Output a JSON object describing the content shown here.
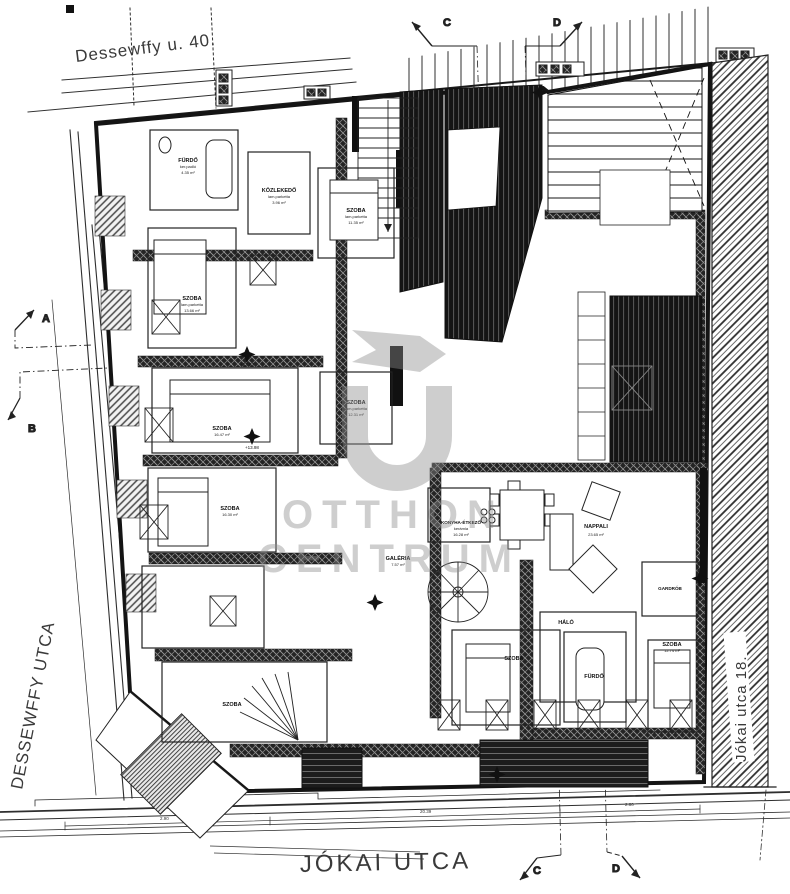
{
  "title": "Tetőtéri alaprajz",
  "streets": {
    "top": "Dessewffy u. 40.",
    "left": "DESSEWFFY UTCA",
    "bottom": "JÓKAI UTCA",
    "right": "Jókai utca 18."
  },
  "section_markers": {
    "a": "A",
    "b": "B",
    "c": "C",
    "d": "D"
  },
  "watermark": {
    "line1": "OTTHON",
    "line2": "CENTRUM"
  },
  "rooms": [
    {
      "label": "FÜRDŐ",
      "sub": "ker.padló",
      "area": "4.35 m²"
    },
    {
      "label": "SZOBA",
      "sub": "lam.parketta",
      "area": "13.66 m²"
    },
    {
      "label": "KÖZLEKEDŐ",
      "sub": "lam.parketta",
      "area": "3.96 m²"
    },
    {
      "label": "SZOBA",
      "sub": "lam.parketta",
      "area": "11.35 m²"
    },
    {
      "label": "SZOBA",
      "sub": "lam.parketta",
      "area": "12.31 m²"
    },
    {
      "label": "SZOBA",
      "sub": "lam.parketta",
      "area": "16.47 m²"
    },
    {
      "label": "SZOBA",
      "sub": "lam.parketta",
      "area": "16.30 m²"
    },
    {
      "label": "SZOBA",
      "sub": "lam.parketta",
      "area": ""
    },
    {
      "label": "GALÉRIA",
      "sub": "",
      "area": "7.57 m²"
    },
    {
      "label": "KONYHA-ÉTKEZŐ",
      "sub": "kerámia",
      "area": "16.28 m²"
    },
    {
      "label": "NAPPALI",
      "sub": "",
      "area": "23.65 m²"
    },
    {
      "label": "GARDRÓB",
      "sub": "",
      "area": ""
    },
    {
      "label": "HÁLÓ",
      "sub": "",
      "area": ""
    },
    {
      "label": "SZOBA",
      "sub": "",
      "area": ""
    },
    {
      "label": "FÜRDŐ",
      "sub": "",
      "area": ""
    },
    {
      "label": "SZOBA",
      "sub": "",
      "area": "12.74 m²"
    }
  ],
  "levels": {
    "l1": "+23.83",
    "l2": "+13.98"
  },
  "dims": {
    "d1": "2.90",
    "d2": "20.39",
    "d3": "2.80"
  },
  "colors": {
    "ink": "#1a1a1a",
    "paper": "#ffffff",
    "watermark": "#8d8d8d"
  }
}
